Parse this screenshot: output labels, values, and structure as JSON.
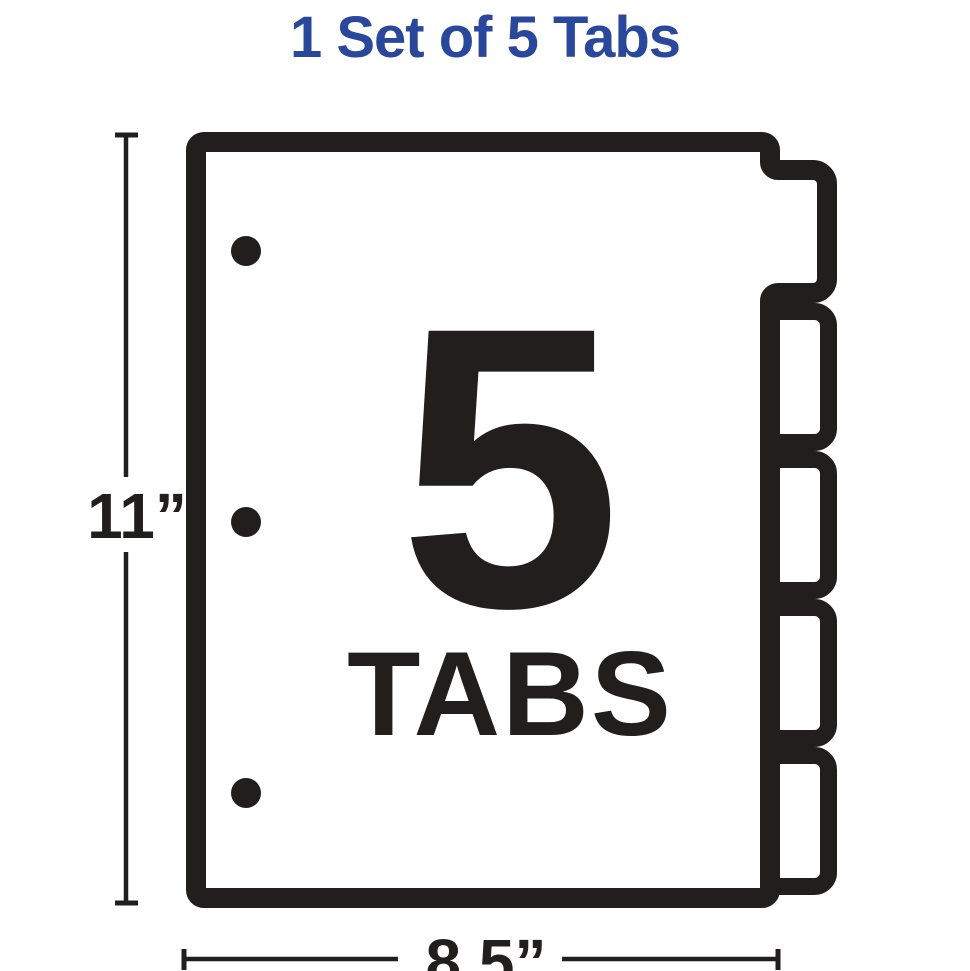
{
  "title": {
    "text": "1 Set of 5 Tabs"
  },
  "colors": {
    "accent_blue": "#2a489b",
    "ink": "#211e1e",
    "background": "#ffffff"
  },
  "divider": {
    "tab_count_number": "5",
    "tab_count_caption": "TABS",
    "tabs_total": 5,
    "punch_holes_total": 3
  },
  "dimensions": {
    "height": "11”",
    "width": "8.5”"
  }
}
